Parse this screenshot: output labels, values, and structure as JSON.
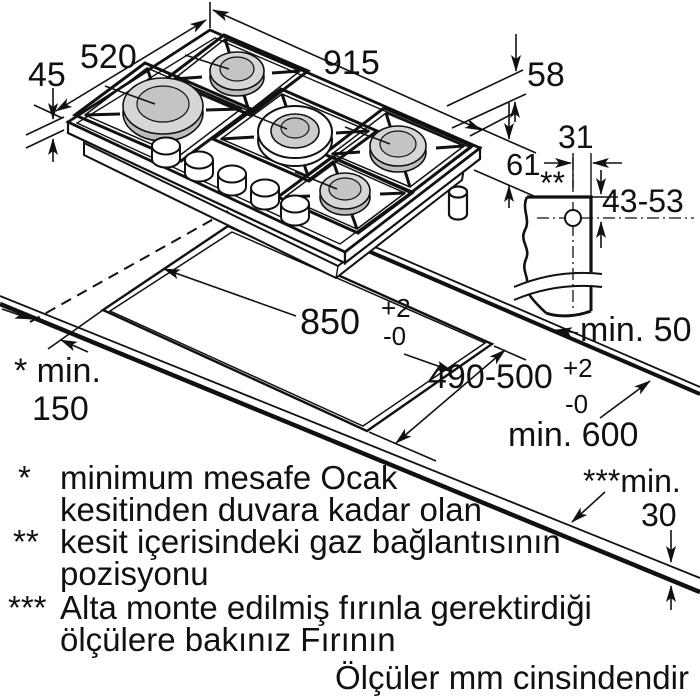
{
  "dims": {
    "thickness": "45",
    "depth": "520",
    "width": "915",
    "below_top": "58",
    "total_height": "61",
    "gas_offset": "31",
    "gas_marker": "**",
    "gas_depth_range": "43-53",
    "cutout_width": "850",
    "cutout_width_plus": "+2",
    "cutout_width_minus": "-0",
    "cutout_depth": "490-500",
    "cutout_depth_plus": "+2",
    "cutout_depth_minus": "-0",
    "side_clearance_label": "* min.",
    "side_clearance_value": "150",
    "rear_clearance": "min. 50",
    "counter_depth": "min. 600",
    "counter_thickness_label": "***min.",
    "counter_thickness_value": "30"
  },
  "footnotes": {
    "star1_mark": "*",
    "star1_line1": "minimum mesafe Ocak",
    "star1_line2": "kesitinden duvara kadar olan",
    "star2_mark": "**",
    "star2_line1": "kesit içerisindeki gaz bağlantısının",
    "star2_line2": "pozisyonu",
    "star3_mark": "***",
    "star3_line1": "Alta monte edilmiş fırınla gerektirdiği",
    "star3_line2": "ölçülere bakınız Fırının",
    "units_note": "Ölçüler mm cinsindendir"
  }
}
